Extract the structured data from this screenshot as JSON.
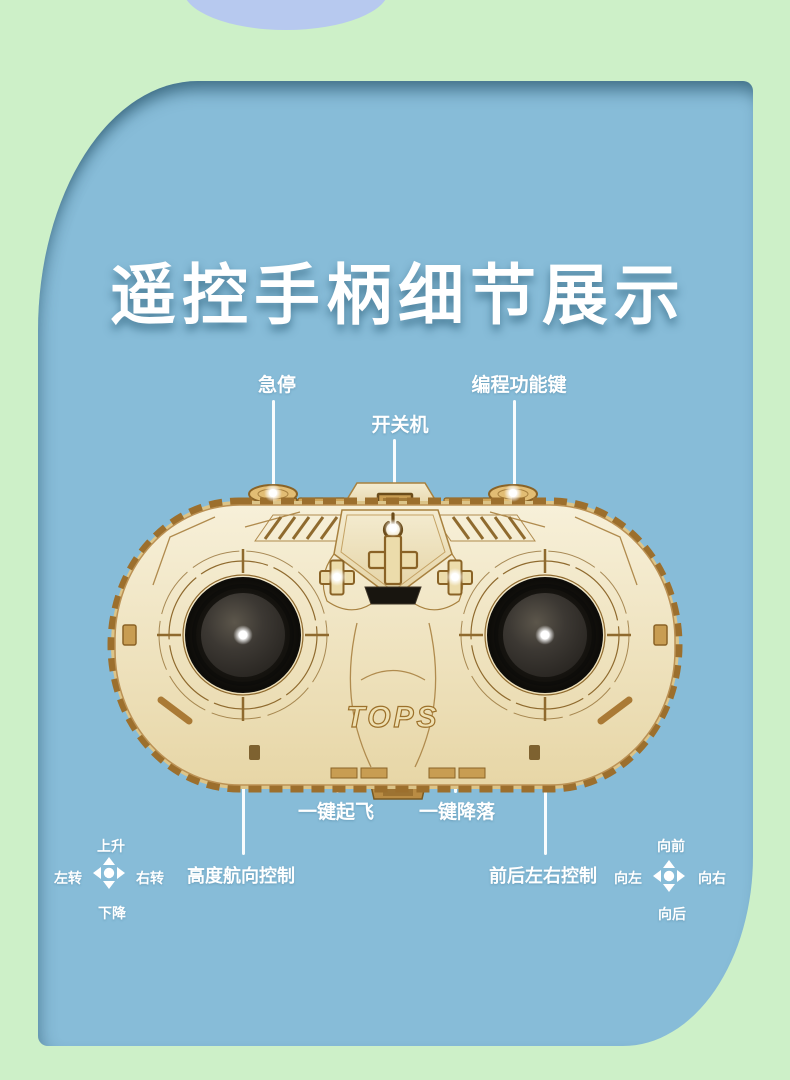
{
  "scene": {
    "title": "遥控手柄细节展示",
    "brand_engraving": "TOPS"
  },
  "callouts": {
    "emergency_stop": "急停",
    "power_switch": "开关机",
    "program_function_key": "编程功能键",
    "one_key_takeoff": "一键起飞",
    "one_key_landing": "一键降落",
    "altitude_heading_control": "高度航向控制",
    "direction_control": "前后左右控制"
  },
  "left_stick_legend": {
    "up": "上升",
    "down": "下降",
    "left": "左转",
    "right": "右转"
  },
  "right_stick_legend": {
    "up": "向前",
    "down": "向后",
    "left": "向左",
    "right": "向右"
  },
  "colors": {
    "background_green": "#cdf0c8",
    "card_blue": "#87bcd8",
    "blob_blue": "#b7c9ef",
    "label_white": "#ffffff",
    "wood_light": "#f1e8cb",
    "wood_outline": "#8f6a2e",
    "joystick_black": "#17150f"
  }
}
